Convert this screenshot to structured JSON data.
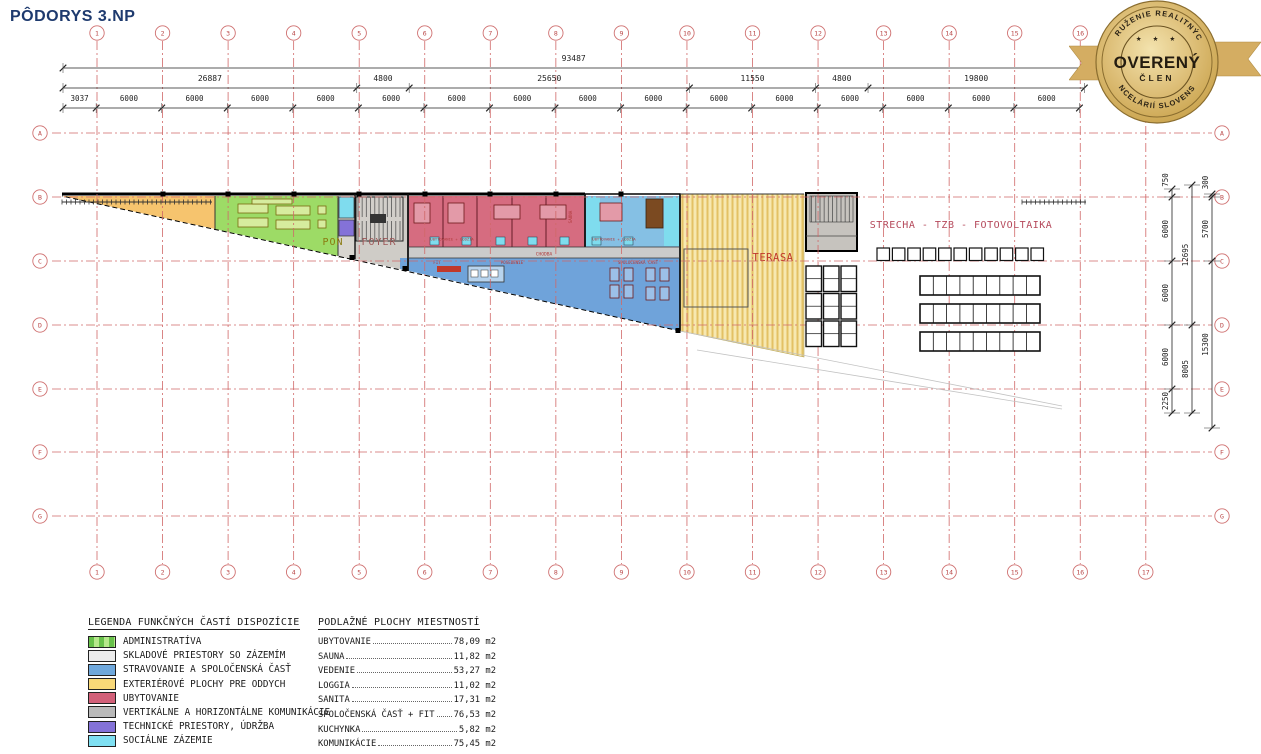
{
  "title": "PÔDORYS 3.NP",
  "badge": {
    "arc_top": "ZDRUŽENIE REALITNÝCH",
    "arc_bottom": "KANCELÁRIÍ SLOVENSKA",
    "stars": "★ ★ ★",
    "main": "OVERENÝ",
    "sub": "ČLEN",
    "gold_dark": "#8a6d2f",
    "gold_mid": "#c9a24b",
    "gold_light": "#f3e3ae",
    "ribbon": "#d4ad62",
    "text_color": "#2a2215"
  },
  "grid": {
    "columns": [
      "1",
      "2",
      "3",
      "4",
      "5",
      "6",
      "7",
      "8",
      "9",
      "10",
      "11",
      "12",
      "13",
      "14",
      "15",
      "16",
      "17"
    ],
    "rows": [
      "A",
      "B",
      "C",
      "D",
      "E",
      "F",
      "G"
    ],
    "line_color": "#d06868"
  },
  "dimensions": {
    "total": "93487",
    "row2": [
      "26887",
      "4800",
      "25650",
      "11550",
      "4800",
      "19800"
    ],
    "row3": [
      "3037",
      "6000",
      "6000",
      "6000",
      "6000",
      "6000",
      "6000",
      "6000",
      "6000",
      "6000",
      "6000",
      "6000",
      "6000",
      "6000",
      "6000",
      "6000"
    ],
    "right_inner": [
      "750",
      "6000",
      "6000",
      "6000",
      "2250"
    ],
    "right_mid": [
      "12695",
      "8005"
    ],
    "right_outer": [
      "300",
      "5700",
      "15300"
    ]
  },
  "plan": {
    "labels": {
      "pon": "PON",
      "foyer": "FOYER",
      "terasa": "TERASA",
      "strecha": "STRECHA - TZB - FOTOVOLTAIKA",
      "chodba": "CHODBA",
      "fit": "FIT",
      "posedenie": "POSEDENIE",
      "spolocenska": "SPOLOČENSKÁ ČASŤ",
      "sauna": "SAUNA",
      "ubytovanie1": "UBYTOVANIE + LODŽIA",
      "ubytovanie2": "UBYTOVANIE + LODŽIA"
    }
  },
  "legend": {
    "title": "LEGENDA FUNKČNÝCH ČASTÍ DISPOZÍCIE",
    "items": [
      {
        "label": "ADMINISTRATÍVA",
        "color": "#68c24b",
        "color2": "#b6e88b"
      },
      {
        "label": "SKLADOVÉ PRIESTORY SO ZÁZEMÍM",
        "color": "#ebebeb"
      },
      {
        "label": "STRAVOVANIE A SPOLOČENSKÁ ČASŤ",
        "color": "#6fa8dc"
      },
      {
        "label": "EXTERIÉROVÉ PLOCHY PRE ODDYCH",
        "color": "#f8d878"
      },
      {
        "label": "UBYTOVANIE",
        "color": "#d26079"
      },
      {
        "label": "VERTIKÁLNE A HORIZONTÁLNE KOMUNIKÁCIE",
        "color": "#b9b9b9"
      },
      {
        "label": "TECHNICKÉ PRIESTORY, ÚDRŽBA",
        "color": "#8472d8"
      },
      {
        "label": "SOCIÁLNE ZÁZEMIE",
        "color": "#7fe0f2"
      }
    ]
  },
  "area_table": {
    "title": "PODLAŽNÉ PLOCHY MIESTNOSTÍ",
    "unit": "m2",
    "rows": [
      {
        "name": "UBYTOVANIE",
        "value": "78,09"
      },
      {
        "name": "SAUNA",
        "value": "11,82"
      },
      {
        "name": "VEDENIE",
        "value": "53,27"
      },
      {
        "name": "LOGGIA",
        "value": "11,02"
      },
      {
        "name": "SANITA",
        "value": "17,31"
      },
      {
        "name": "SPOLOČENSKÁ ČASŤ + FIT",
        "value": "76,53"
      },
      {
        "name": "KUCHYNKA",
        "value": "5,82"
      },
      {
        "name": "KOMUNIKÁCIE",
        "value": "75,45"
      }
    ]
  }
}
